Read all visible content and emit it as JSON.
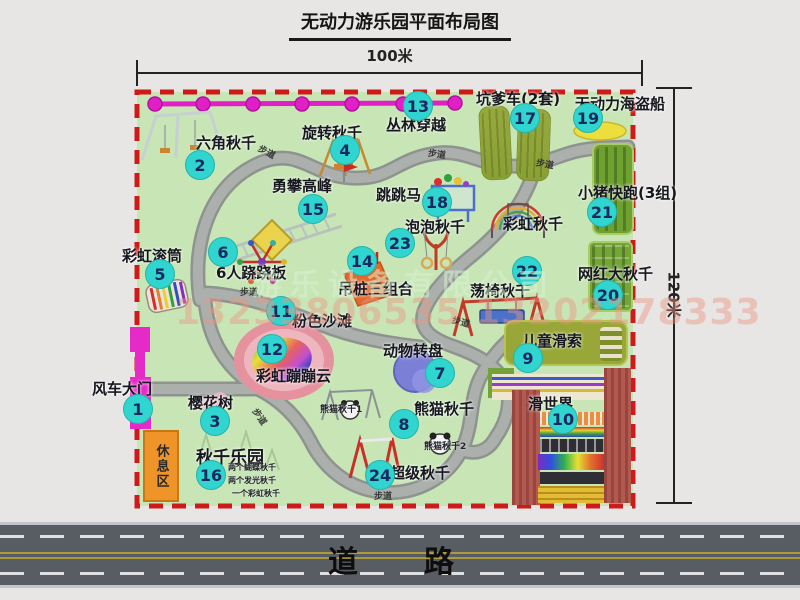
{
  "title": "无动力游乐园平面布局图",
  "dimensions": {
    "width": "100米",
    "height": "120米"
  },
  "road_label": "道　路",
  "path_label": "步道",
  "rest_area_label": "休息区",
  "watermark": {
    "company": "游乐设备有限公司",
    "phone": "13233806535 13202178333"
  },
  "attractions": [
    {
      "num": "1",
      "label": "风车大门"
    },
    {
      "num": "2",
      "label": "六角秋千"
    },
    {
      "num": "3",
      "label": "樱花树"
    },
    {
      "num": "4",
      "label": "旋转秋千"
    },
    {
      "num": "5",
      "label": "彩虹滚筒"
    },
    {
      "num": "6",
      "label": "6人跷跷板"
    },
    {
      "num": "7",
      "label": "动物转盘"
    },
    {
      "num": "8",
      "label": "熊猫秋千"
    },
    {
      "num": "9",
      "label": "儿童滑索"
    },
    {
      "num": "10",
      "label": "滑世界"
    },
    {
      "num": "11",
      "label": "粉色沙滩"
    },
    {
      "num": "12",
      "label": "彩虹蹦蹦云"
    },
    {
      "num": "13",
      "label": "丛林穿越"
    },
    {
      "num": "14",
      "label": "吊桩三组合"
    },
    {
      "num": "15",
      "label": "勇攀高峰"
    },
    {
      "num": "16",
      "label": "秋千乐园"
    },
    {
      "num": "17",
      "label": "坑爹车(2套)"
    },
    {
      "num": "18",
      "label": "跳跳马"
    },
    {
      "num": "19",
      "label": "无动力海盗船"
    },
    {
      "num": "20",
      "label": "网红大秋千"
    },
    {
      "num": "21",
      "label": "小猪快跑(3组)"
    },
    {
      "num": "22",
      "label": "荡椅秋千"
    },
    {
      "num": "23",
      "label": "泡泡秋千"
    },
    {
      "num": "24",
      "label": "超级秋千"
    },
    {
      "num": "",
      "label": "彩虹秋千"
    }
  ],
  "sub_labels": {
    "panda1": "熊猫秋千1",
    "panda2": "熊猫秋千2",
    "swing_notes": [
      "两个蝴蝶秋千",
      "两个发光秋千",
      "一个彩虹秋千"
    ]
  },
  "colors": {
    "map_bg": "#c8e5b6",
    "border_red": "#cf1a1a",
    "badge_teal": "#2fd5ce",
    "magenta": "#e11fc6",
    "road_gray": "#585c63",
    "rest_area_orange": "#ef9428",
    "olive_green": "#98a738"
  }
}
